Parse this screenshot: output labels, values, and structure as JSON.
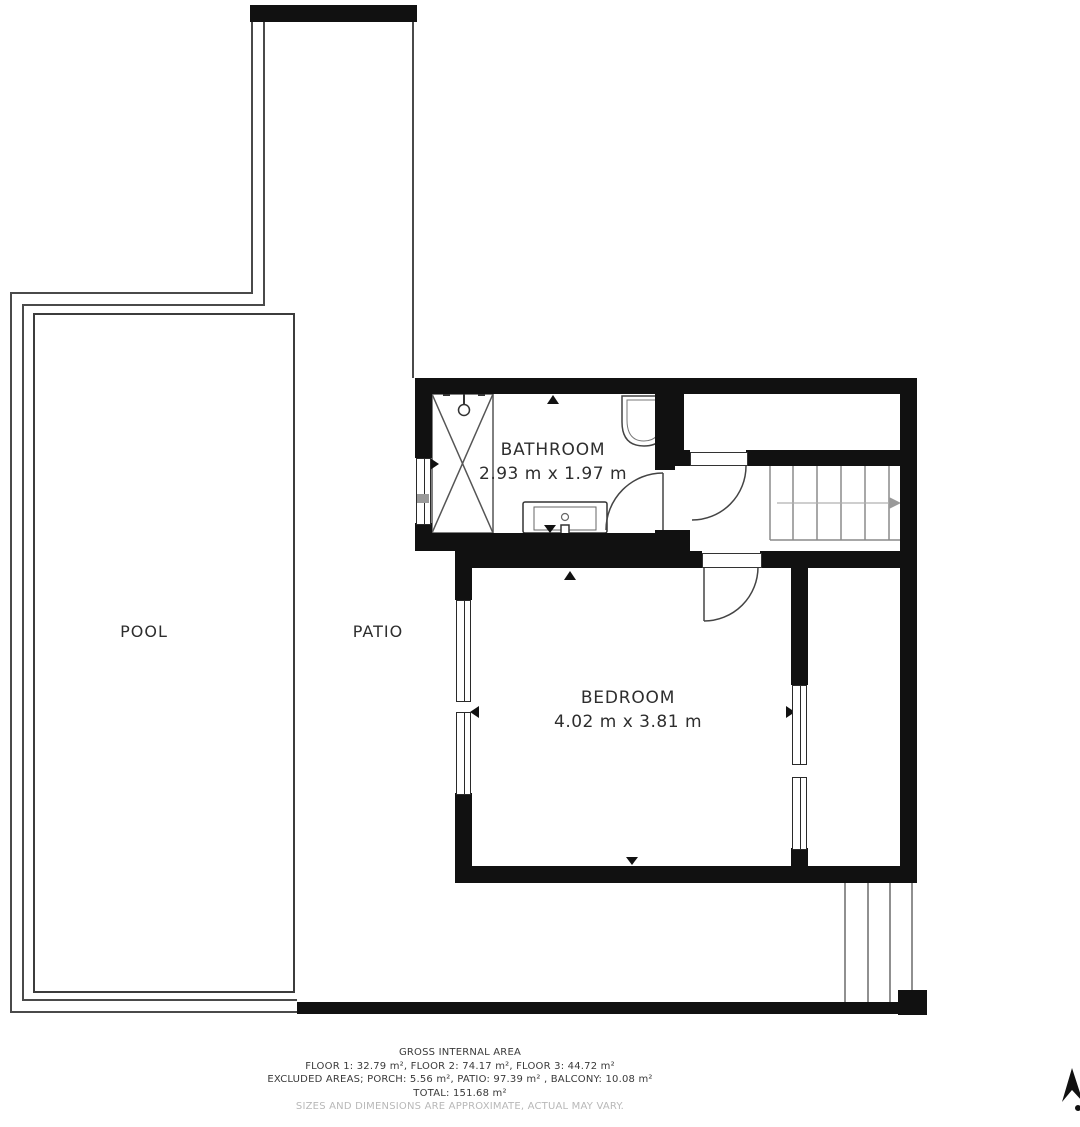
{
  "labels": {
    "pool": "POOL",
    "patio": "PATIO"
  },
  "rooms": {
    "bathroom": {
      "name": "BATHROOM",
      "dims": "2.93 m x 1.97 m"
    },
    "bedroom": {
      "name": "BEDROOM",
      "dims": "4.02 m x 3.81 m"
    }
  },
  "footer": {
    "title": "GROSS INTERNAL AREA",
    "floors": "FLOOR 1: 32.79 m², FLOOR 2: 74.17 m², FLOOR 3: 44.72 m²",
    "excluded": "EXCLUDED AREAS; PORCH: 5.56 m², PATIO: 97.39 m² , BALCONY: 10.08 m²",
    "total": "TOTAL: 151.68 m²",
    "disclaimer": "SIZES AND DIMENSIONS ARE APPROXIMATE, ACTUAL MAY VARY."
  },
  "colors": {
    "wall": "#111111",
    "line": "#4a4a4a",
    "text": "#2e2e2e",
    "muted": "#b8b8b8"
  }
}
